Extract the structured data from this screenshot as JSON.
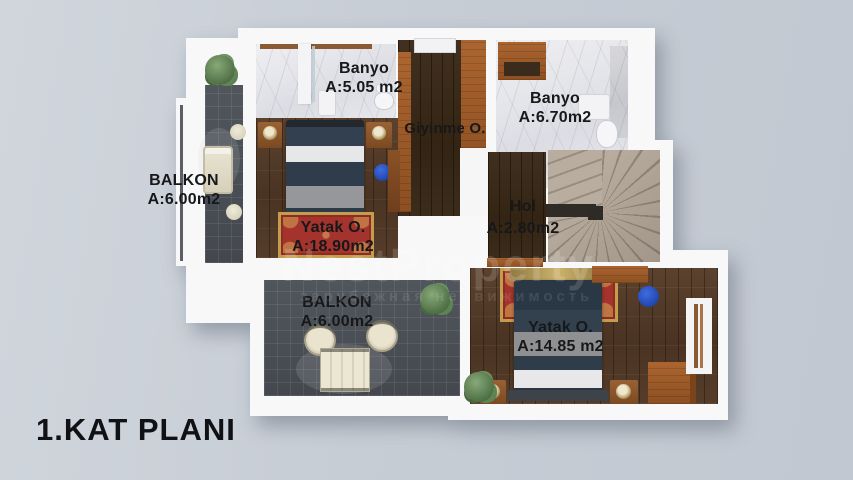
{
  "title": "1.KAT PLANI",
  "watermark": {
    "brand": "NestProperty",
    "tagline": "зарубежная недвижимость"
  },
  "rooms": {
    "balkon_left": {
      "name": "BALKON",
      "area": "A:6.00m2"
    },
    "banyo_top": {
      "name": "Banyo",
      "area": "A:5.05 m2"
    },
    "giyinme": {
      "name": "Giyinme O."
    },
    "banyo_right": {
      "name": "Banyo",
      "area": "A:6.70m2"
    },
    "yatak_left": {
      "name": "Yatak O.",
      "area": "A:18.90m2"
    },
    "hol": {
      "name": "Hol",
      "area": "A:2.80m2"
    },
    "balkon_bottom": {
      "name": "BALKON",
      "area": "A:6.00m2"
    },
    "yatak_right": {
      "name": "Yatak O.",
      "area": "A:14.85 m2"
    }
  },
  "colors": {
    "background": "#c7cdd5",
    "walls": "#f8f8f9",
    "wood_floor": "#4d3826",
    "tile_floor": "#4b5056",
    "marble_floor": "#e8e9ed",
    "cabinet_wood": "#a3602c",
    "stairs": "#b3a799",
    "bedding_navy": "#2e3c4b",
    "rug_red": "#a4332e",
    "stool_blue": "#2a52c6",
    "label_text": "#17181a"
  }
}
